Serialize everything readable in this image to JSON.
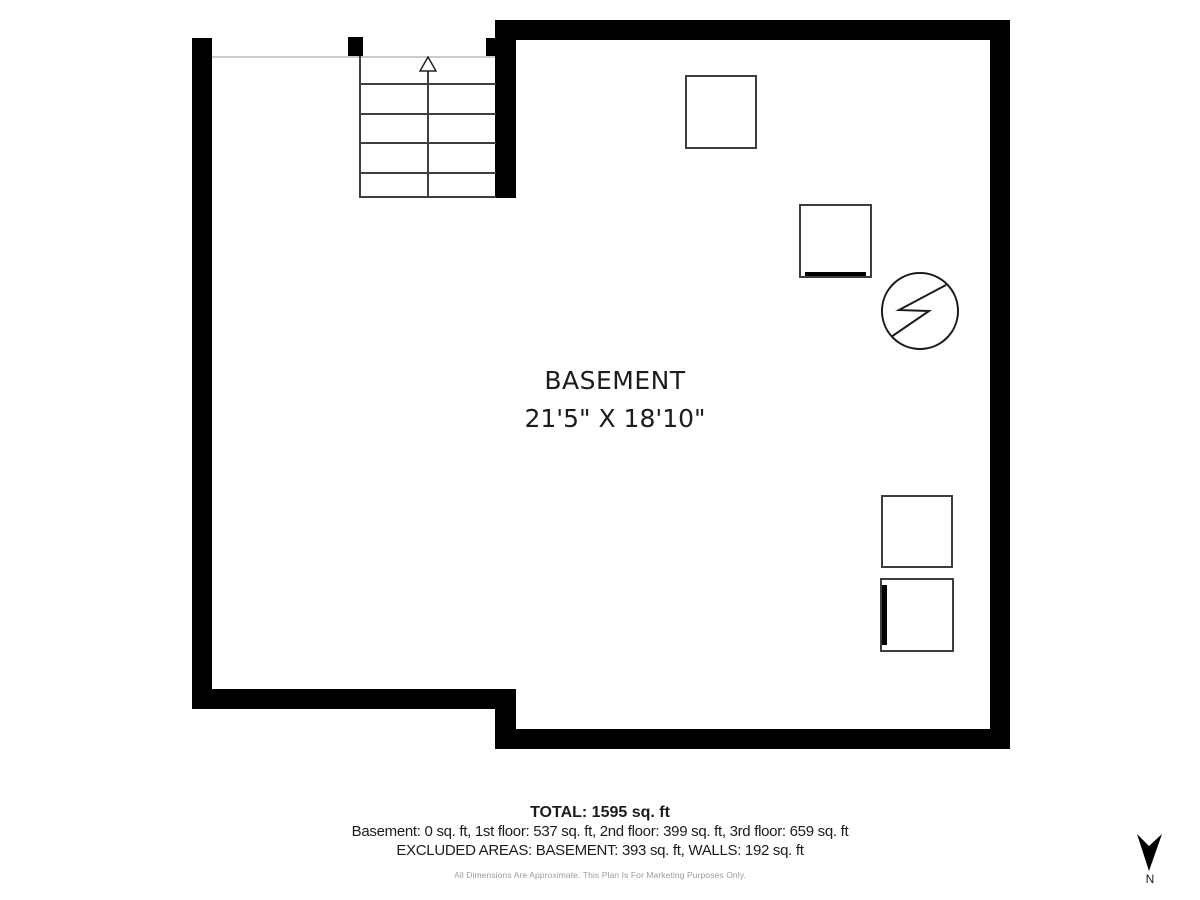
{
  "room": {
    "name": "BASEMENT",
    "dimensions": "21'5\" X 18'10\""
  },
  "footer": {
    "total": "TOTAL: 1595 sq. ft",
    "floors": "Basement: 0 sq. ft, 1st floor: 537 sq. ft, 2nd floor: 399 sq. ft, 3rd floor: 659 sq. ft",
    "excluded": "EXCLUDED AREAS: BASEMENT: 393 sq. ft, WALLS: 192 sq. ft",
    "disclaimer": "All Dimensions Are Approximate. This Plan Is For Marketing Purposes Only."
  },
  "compass": {
    "label": "N"
  },
  "plan": {
    "stairs": {
      "tread_lines": 5,
      "direction_icon": "up-arrow"
    },
    "fixtures": [
      "square-fixture",
      "square-fixture-with-bottom-element",
      "utility-circle-symbol",
      "square-fixture",
      "square-fixture-with-left-element"
    ],
    "colors": {
      "wall": "#000000",
      "fixture_line": "#3d3d3d",
      "stair_line": "#3f3f3f",
      "open_edge": "#cccccc",
      "text": "#1c1c1c",
      "muted_text": "#9b9b9b"
    }
  }
}
